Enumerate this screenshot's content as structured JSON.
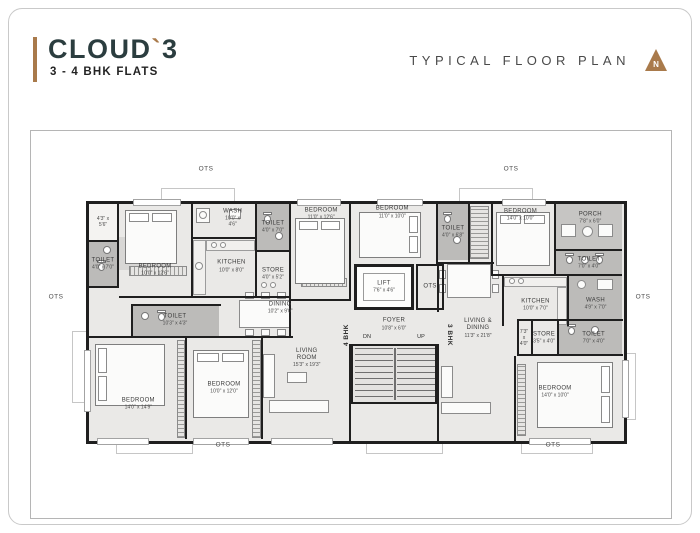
{
  "header": {
    "logo": {
      "part1": "CLOUD",
      "tick": "`",
      "part2": "3"
    },
    "subtitle": "3 - 4 BHK FLATS",
    "title": "TYPICAL FLOOR PLAN",
    "north_label": "N"
  },
  "colors": {
    "accent_tan": "#a97a4b",
    "logo_teal": "#2b3d3f",
    "wall_black": "#1f1f1f",
    "floor_gray": "#eae9e7",
    "wet_gray": "#bcbbb9",
    "plant_green": "#8fb268"
  },
  "plan": {
    "unit_left_label": "4 BHK",
    "unit_right_label": "3 BHK",
    "core_ots_label": "OTS",
    "stairs": {
      "down_label": "DN",
      "up_label": "UP"
    },
    "ots_labels": [
      "OTS",
      "OTS",
      "OTS",
      "OTS",
      "OTS",
      "OTS"
    ],
    "rooms": [
      {
        "name": "",
        "dims": "4'3\" x 5'6\""
      },
      {
        "name": "TOILET",
        "dims": "4'0\" x 7'0\""
      },
      {
        "name": "BEDROOM",
        "dims": "10'0\" x 12'6\""
      },
      {
        "name": "WASH",
        "dims": "10'0\" x 4'6\""
      },
      {
        "name": "TOILET",
        "dims": "4'0\" x 7'0\""
      },
      {
        "name": "KITCHEN",
        "dims": "10'0\" x 8'0\""
      },
      {
        "name": "STORE",
        "dims": "4'0\" x 5'2\""
      },
      {
        "name": "DINING",
        "dims": "10'2\" x 9'0\""
      },
      {
        "name": "TOILET",
        "dims": "10'3\" x 4'3\""
      },
      {
        "name": "BEDROOM",
        "dims": "14'0\" x 14'9\""
      },
      {
        "name": "BEDROOM",
        "dims": "10'0\" x 12'0\""
      },
      {
        "name": "LIVING ROOM",
        "dims": "15'3\" x 19'3\""
      },
      {
        "name": "BEDROOM",
        "dims": "11'0\" x 12'6\""
      },
      {
        "name": "BEDROOM",
        "dims": "11'0\" x 10'0\""
      },
      {
        "name": "LIFT",
        "dims": "7'6\" x 4'6\""
      },
      {
        "name": "FOYER",
        "dims": "10'8\" x 6'0\""
      },
      {
        "name": "TOILET",
        "dims": "4'0\" x 6'8\""
      },
      {
        "name": "BEDROOM",
        "dims": "14'0\" x 10'0\""
      },
      {
        "name": "PORCH",
        "dims": "7'8\" x 6'0\""
      },
      {
        "name": "TOILET",
        "dims": "7'0\" x 4'0\""
      },
      {
        "name": "KITCHEN",
        "dims": "10'0\" x 7'0\""
      },
      {
        "name": "WASH",
        "dims": "4'9\" x 7'0\""
      },
      {
        "name": "LIVING & DINING",
        "dims": "11'3\" x 21'8\""
      },
      {
        "name": "",
        "dims": "7'3\" x 4'0\""
      },
      {
        "name": "STORE",
        "dims": "3'5\" x 4'0\""
      },
      {
        "name": "TOILET",
        "dims": "7'0\" x 4'0\""
      },
      {
        "name": "BEDROOM",
        "dims": "14'0\" x 10'0\""
      }
    ]
  }
}
